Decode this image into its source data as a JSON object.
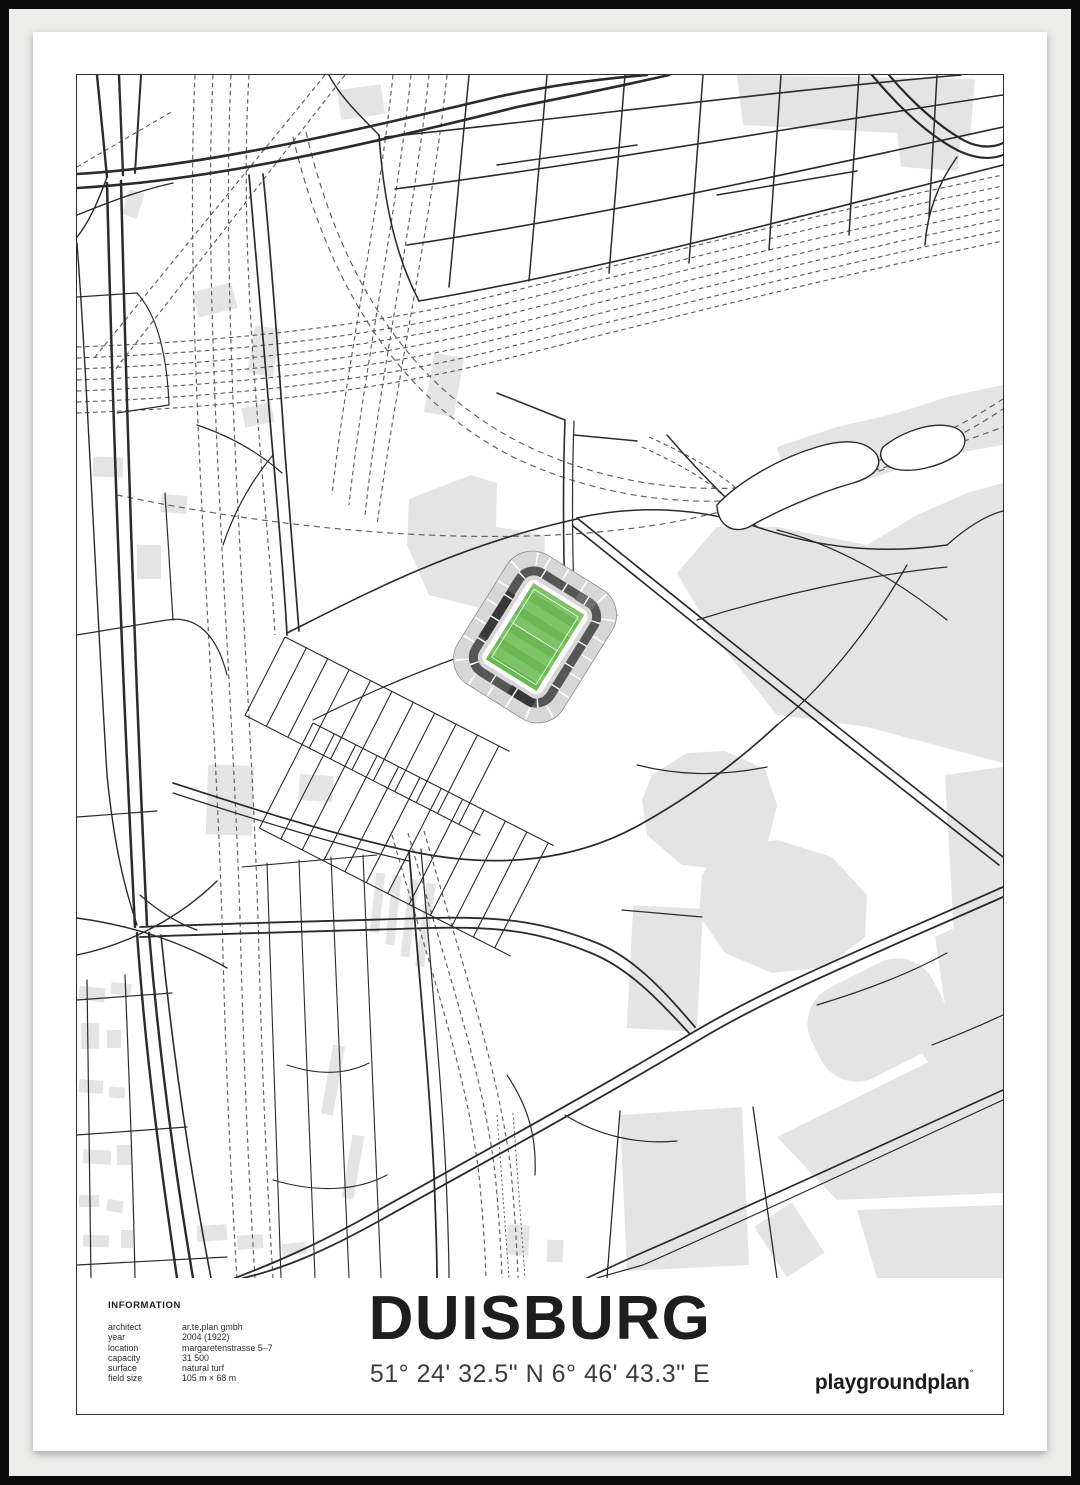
{
  "poster": {
    "info": {
      "heading": "INFORMATION",
      "rows": [
        {
          "label": "architect",
          "value": "ar.te.plan gmbh"
        },
        {
          "label": "year",
          "value": "2004 (1922)"
        },
        {
          "label": "location",
          "value": "margaretenstrasse 5–7"
        },
        {
          "label": "capacity",
          "value": "31 500"
        },
        {
          "label": "surface",
          "value": "natural turf"
        },
        {
          "label": "field size",
          "value": "105 m × 68 m"
        }
      ]
    },
    "title": "DUISBURG",
    "coordinates": "51° 24' 32.5\" N 6° 46' 43.3\" E",
    "brand": "playgroundplan",
    "brand_mark": "°",
    "map": {
      "stadium_name": "MSV arena",
      "pitch_light": "#7cc465",
      "pitch_dark": "#6cb854",
      "stand_fill": "#d7d7d7",
      "stand_ring": "#565656",
      "building_fill": "#e4e4e4",
      "road_color": "#2b2b2b",
      "rail_color": "#5e5e5e"
    }
  }
}
